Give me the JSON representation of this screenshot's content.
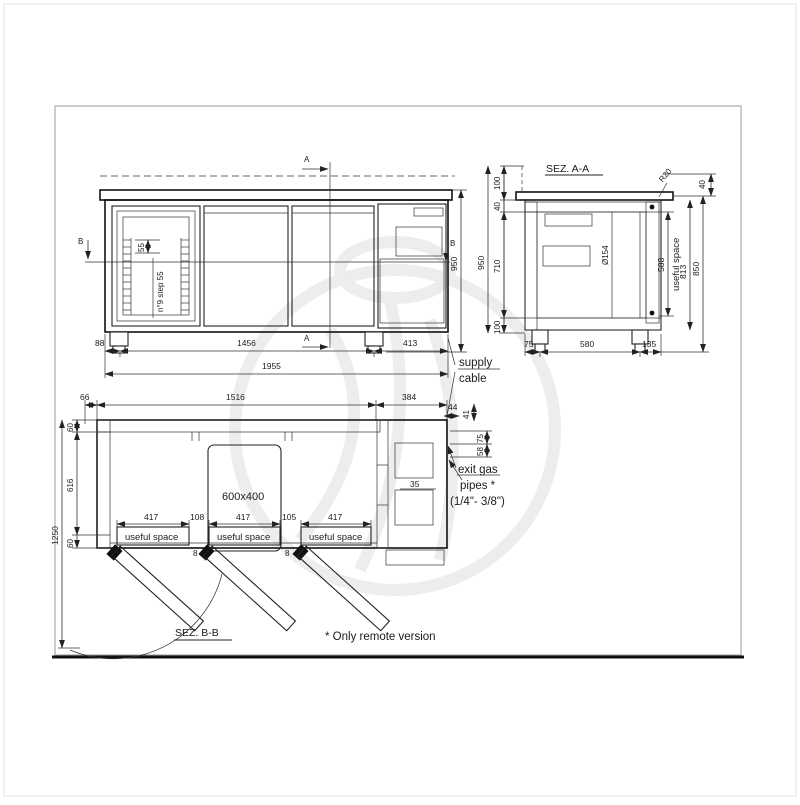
{
  "front": {
    "marker_a": "A",
    "marker_b": "B",
    "shelf_pitch": "55",
    "shelf_note": "n°9 step 55",
    "height_total": "950",
    "dim_left": "88",
    "dim_feet": "1456",
    "dim_right": "413",
    "dim_total": "1955"
  },
  "supply": {
    "line1": "supply",
    "line2": "cable"
  },
  "section_aa": {
    "title": "SEZ. A-A",
    "dim_upstand": "100",
    "dim_top": "40",
    "dim_interior": "710",
    "dim_bottom": "100",
    "dim_height": "950",
    "radius": "R20",
    "dim_overhang": "40",
    "pipe_dia": "Ø154",
    "dim_useful": "588",
    "useful_label": "useful space",
    "dim_inner_h": "813",
    "dim_body_h": "850",
    "dim_d75": "75",
    "dim_d580": "580",
    "dim_d135": "135"
  },
  "plan": {
    "title": "SEZ. B-B",
    "dim_door": "66",
    "dim_body": "1516",
    "dim_motor": "384",
    "dim_44": "44",
    "dim_41": "41",
    "dim_wall_top": "60",
    "dim_depth": "616",
    "dim_wall_bottom": "60",
    "dim_total_depth": "1250",
    "drawer_size": "600x400",
    "dim_417": "417",
    "dim_108": "108",
    "dim_105": "105",
    "dim_8": "8",
    "useful_label": "useful space",
    "dim_35": "35",
    "dim_pipe_75": "75",
    "dim_pipe_58": "58",
    "exit_line1": "exit gas",
    "exit_line2": "pipes *",
    "exit_line3": "(1/4\"- 3/8\")"
  },
  "footnote": "* Only remote version"
}
